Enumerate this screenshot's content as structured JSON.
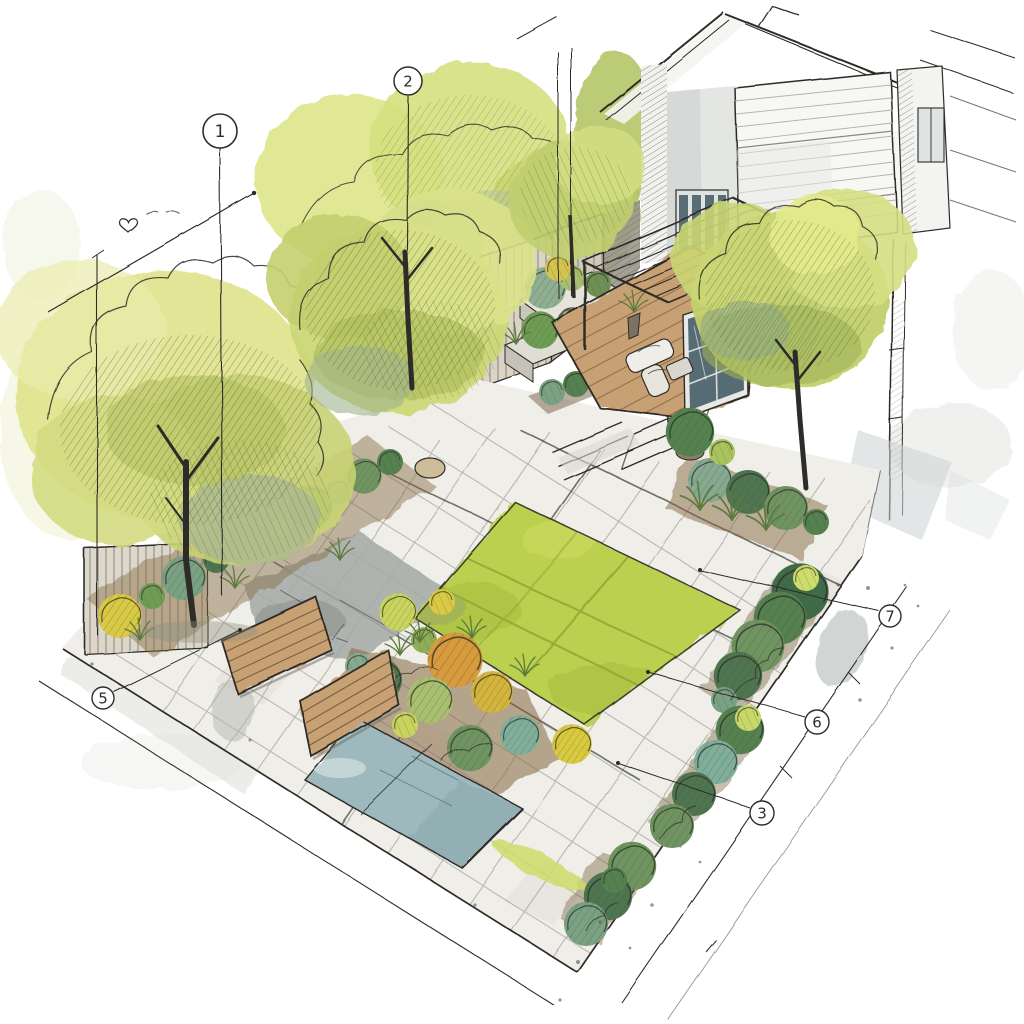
{
  "meta": {
    "title": "Axonometric garden design sketch",
    "medium": "ink and watercolour"
  },
  "palette": {
    "paper": "#ffffff",
    "ink": "#2e2c28",
    "lawn": "#bcd04f",
    "lawn_shade": "#a3b93c",
    "foliage_light": "#dde58c",
    "foliage_mid": "#c3d06f",
    "foliage_dark": "#55804f",
    "foliage_deep": "#4e7450",
    "foliage_teal": "#86a98f",
    "shrub_yellow": "#d9c944",
    "shrub_orange": "#d79a3c",
    "soil": "#85693f",
    "wood": "#c7a173",
    "wood_dark": "#6d5538",
    "stone": "#efeee8",
    "stone_grey": "#a5a9a6",
    "water": "#9db9bd",
    "wall_shade": "#ccd2d1",
    "glass": "#4a5f6b",
    "fence": "#d9d4c6"
  },
  "callouts": [
    {
      "label": "1"
    },
    {
      "label": "2"
    },
    {
      "label": "7"
    },
    {
      "label": "6"
    },
    {
      "label": "3"
    },
    {
      "label": "5"
    }
  ],
  "features": [
    {
      "name": "deciduous-tree",
      "swatch": "foliage_mid"
    },
    {
      "name": "boundary-fence",
      "swatch": "fence"
    },
    {
      "name": "house-facade",
      "swatch": "wall_shade"
    },
    {
      "name": "terrace-glass-door",
      "swatch": "glass"
    },
    {
      "name": "pergola-deck",
      "swatch": "wood"
    },
    {
      "name": "raised-planter",
      "swatch": "stone"
    },
    {
      "name": "stone-paving",
      "swatch": "stone"
    },
    {
      "name": "lawn-panel",
      "swatch": "lawn"
    },
    {
      "name": "perennial-border",
      "swatch": "shrub_orange"
    },
    {
      "name": "clipped-hedge-row",
      "swatch": "foliage_deep"
    },
    {
      "name": "water-basin",
      "swatch": "water"
    },
    {
      "name": "timber-deck-pad",
      "swatch": "wood"
    },
    {
      "name": "dimension-line",
      "swatch": "ink"
    },
    {
      "name": "numbered-callout",
      "swatch": "ink"
    }
  ]
}
